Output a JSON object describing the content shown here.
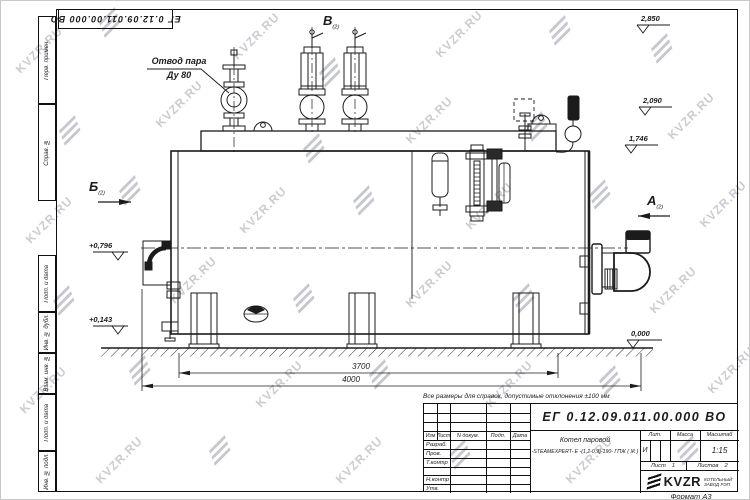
{
  "watermark": {
    "text": "KVZR.RU"
  },
  "corner_stamp": "ЕГ 0.12.09.011.00.000  ВО",
  "frame_strips": [
    "Перв. примен.",
    "Справ. №",
    "Подп. и дата",
    "Инв. № дубл.",
    "Взам. инв. №",
    "Подп. и дата",
    "Инв. № подл."
  ],
  "drawing": {
    "labels": {
      "steam_outlet_line1": "Отвод пара",
      "steam_outlet_line2": "Ду 80"
    },
    "view_markers": {
      "left": "Б",
      "top": "В",
      "right": "А",
      "ref": "(2)"
    },
    "elevations": {
      "right_top": "2,850",
      "right_mid": "2,090",
      "right_low": "1,746",
      "zero": "0,000",
      "left_upper": "+0,796",
      "left_lower": "+0,143"
    },
    "dimensions": {
      "inner": "3700",
      "overall": "4000"
    },
    "note": "Все размеры для справок, допустимые отклонения ±100 мм"
  },
  "title_block": {
    "doc_number": "ЕГ 0.12.09.011.00.000  ВО",
    "product_name_line1": "Котел паровой",
    "product_name_line2": "-STEAMEXPERT- Е -(1,2-0,9)-190- ГПЖ ( Ж )",
    "columns": {
      "izm": "Изм",
      "list": "Лист",
      "n_dokum": "N докум.",
      "podp": "Подп.",
      "data": "Дата"
    },
    "rows": [
      {
        "label": "Разраб."
      },
      {
        "label": "Пров."
      },
      {
        "label": "Т.контр"
      },
      {
        "label": ""
      },
      {
        "label": "Н.контр"
      },
      {
        "label": "Утв."
      }
    ],
    "lit_label": "Лит.",
    "lit_value": "И",
    "mass_label": "Масса",
    "scale_label": "Масштаб",
    "scale_value": "1:15",
    "sheet_label": "Лист",
    "sheet_value": "1",
    "sheets_label": "Листов",
    "sheets_value": "2",
    "logo_text": "KVZR",
    "logo_sub_line1": "КОТЕЛЬНЫЙ",
    "logo_sub_line2": "ЗАВОД РЭП",
    "format_label": "Формат А3"
  }
}
